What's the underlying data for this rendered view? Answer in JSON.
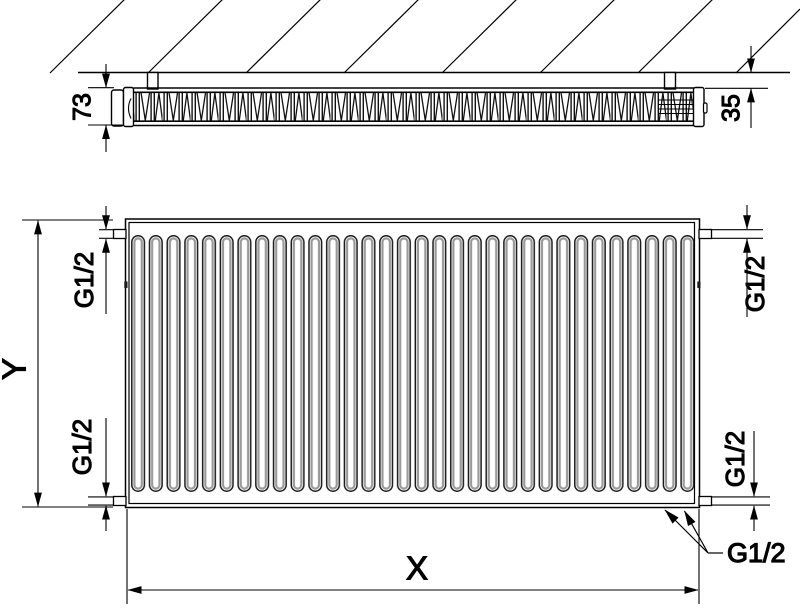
{
  "diagram": {
    "view_top": {
      "depth_dimension": "73",
      "wall_clearance_dimension": "35"
    },
    "view_front": {
      "height_dimension": "Y",
      "width_dimension": "X",
      "thread_top_left": "G1/2",
      "thread_top_right": "G1/2",
      "thread_bottom_left": "G1/2",
      "thread_bottom_right": "G1/2",
      "thread_bottom_center": "G1/2"
    },
    "colors": {
      "line": "#000000",
      "channel_shade": "#9a9a9a",
      "background": "#ffffff"
    }
  }
}
